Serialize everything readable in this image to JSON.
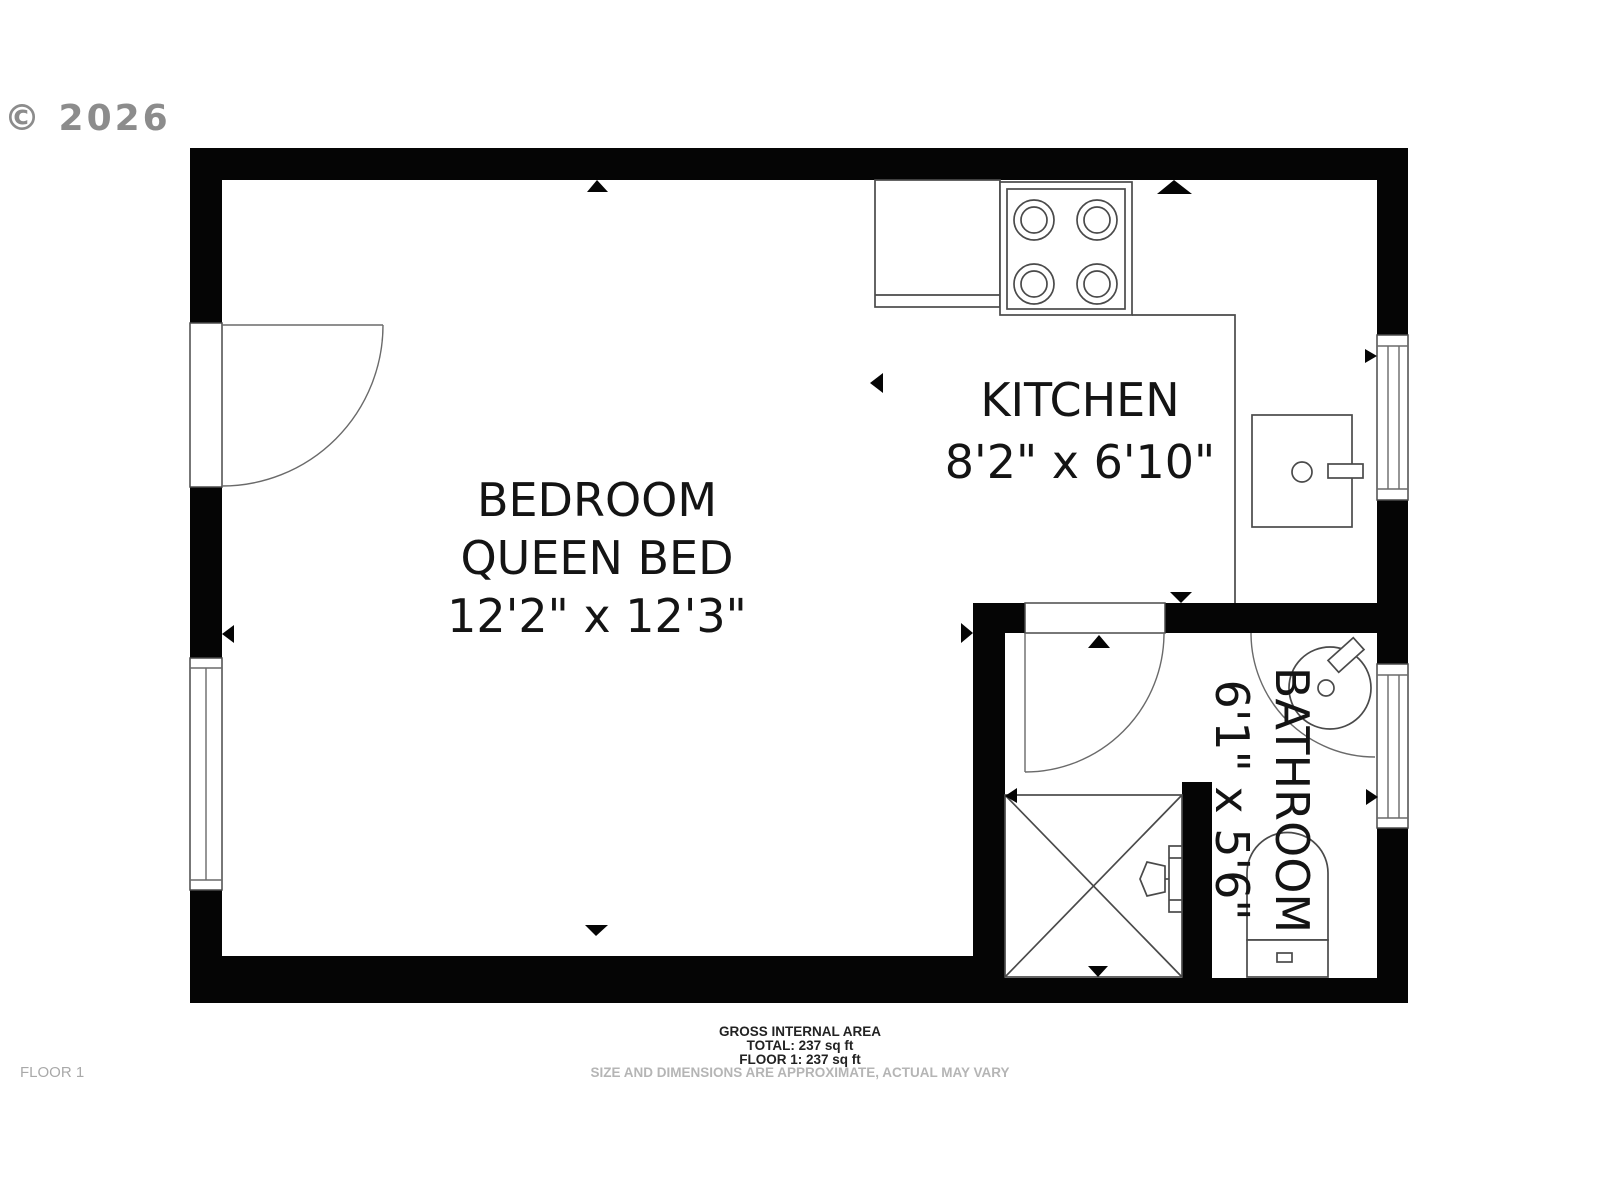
{
  "watermark": "© 2026",
  "floor_label": "FLOOR 1",
  "rooms": {
    "bedroom": {
      "name": "BEDROOM",
      "subtitle": "QUEEN BED",
      "dimensions": "12'2\" x 12'3\""
    },
    "kitchen": {
      "name": "KITCHEN",
      "dimensions": "8'2\" x 6'10\""
    },
    "bathroom": {
      "name": "BATHROOM",
      "dimensions": "6'1\" x 5'6\""
    }
  },
  "footer": {
    "title": "GROSS INTERNAL AREA",
    "total": "TOTAL: 237 sq ft",
    "floor": "FLOOR 1: 237 sq ft",
    "disclaimer": "SIZE AND DIMENSIONS ARE APPROXIMATE, ACTUAL MAY VARY"
  },
  "colors": {
    "wall": "#050505",
    "fixture_line": "#4a4a4a",
    "watermark": "#8c8c8c",
    "muted_text": "#b5b5b5"
  }
}
